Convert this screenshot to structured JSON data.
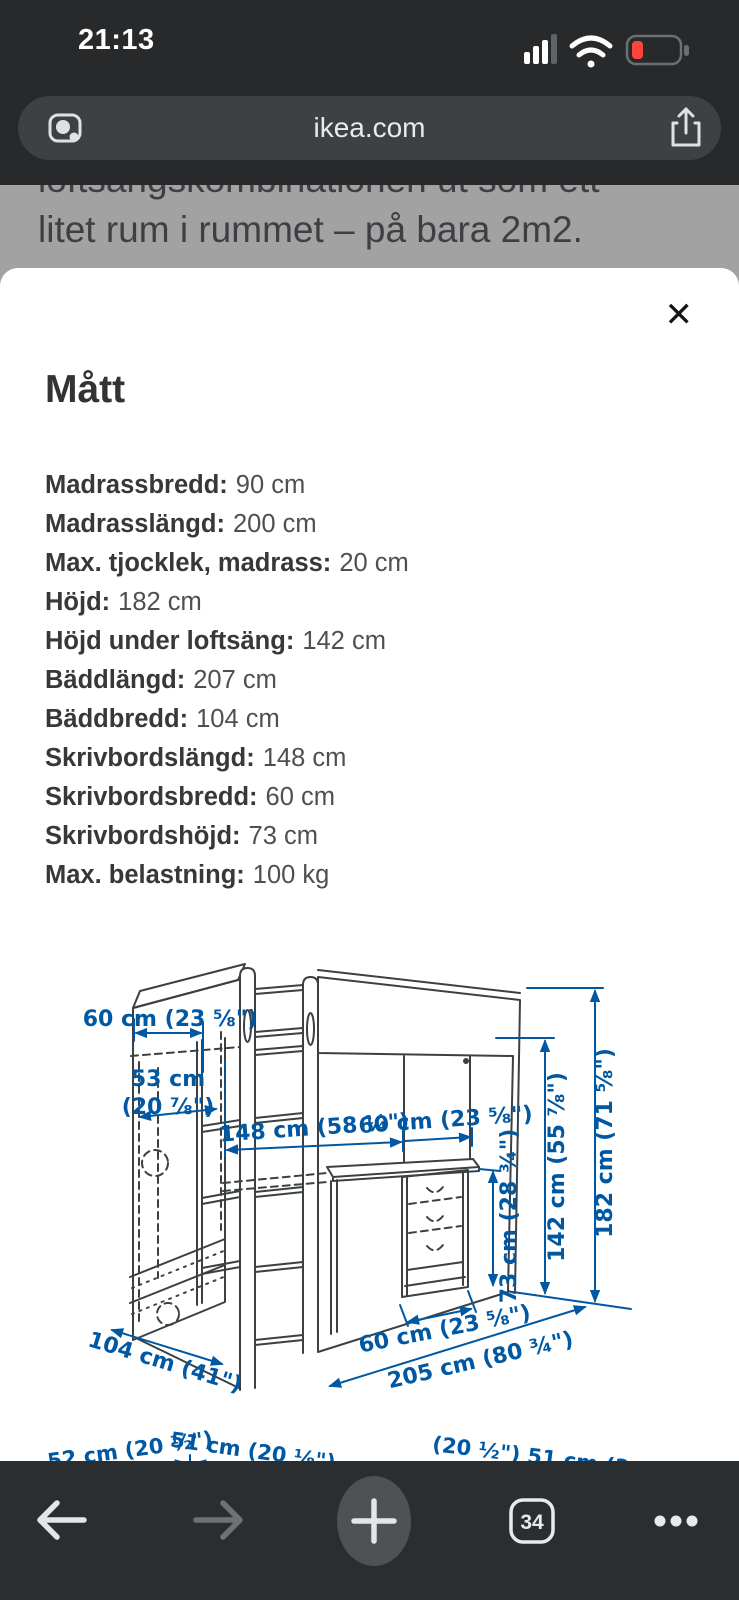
{
  "status_bar": {
    "time": "21:13",
    "battery_state": "low-red"
  },
  "address_bar": {
    "url": "ikea.com"
  },
  "page_background": {
    "line1": "loftsängskombinationen ut som ett",
    "line2": "litet rum i rummet – på bara 2m2."
  },
  "sheet": {
    "title": "Mått",
    "close_icon": "✕",
    "measurements": [
      {
        "label": "Madrassbredd:",
        "value": "90 cm"
      },
      {
        "label": "Madrasslängd:",
        "value": "200 cm"
      },
      {
        "label": "Max. tjocklek, madrass:",
        "value": "20 cm"
      },
      {
        "label": "Höjd:",
        "value": "182 cm"
      },
      {
        "label": "Höjd under loftsäng:",
        "value": "142 cm"
      },
      {
        "label": "Bäddlängd:",
        "value": "207 cm"
      },
      {
        "label": "Bäddbredd:",
        "value": "104 cm"
      },
      {
        "label": "Skrivbordslängd:",
        "value": "148 cm"
      },
      {
        "label": "Skrivbordsbredd:",
        "value": "60 cm"
      },
      {
        "label": "Skrivbordshöjd:",
        "value": "73 cm"
      },
      {
        "label": "Max. belastning:",
        "value": "100 kg"
      }
    ],
    "diagram": {
      "accent_color": "#0058a3",
      "dimensions": {
        "wardrobe_depth": "60 cm (23 ⅝\")",
        "wardrobe_interior_line1": "53 cm",
        "wardrobe_interior_line2": "(20 ⅞\")",
        "desk_length": "148 cm (58 ¼\")",
        "desk_depth": "60 cm (23 ⅝\")",
        "desk_height": "73 cm (28 ¾\")",
        "height_under_loft": "142 cm (55 ⅞\")",
        "total_height": "182 cm (71 ⅝\")",
        "total_depth": "104 cm (41\")",
        "drawer_unit_width": "60 cm (23 ⅝\")",
        "total_length": "205 cm (80 ¾\")",
        "bottom_left_a": "52 cm (20 ½\")",
        "bottom_left_b": "51 cm (20 ⅛\")",
        "bottom_right_partial": "(20 ½\") 51 cm (2"
      }
    }
  },
  "toolbar": {
    "tab_count": "34"
  }
}
